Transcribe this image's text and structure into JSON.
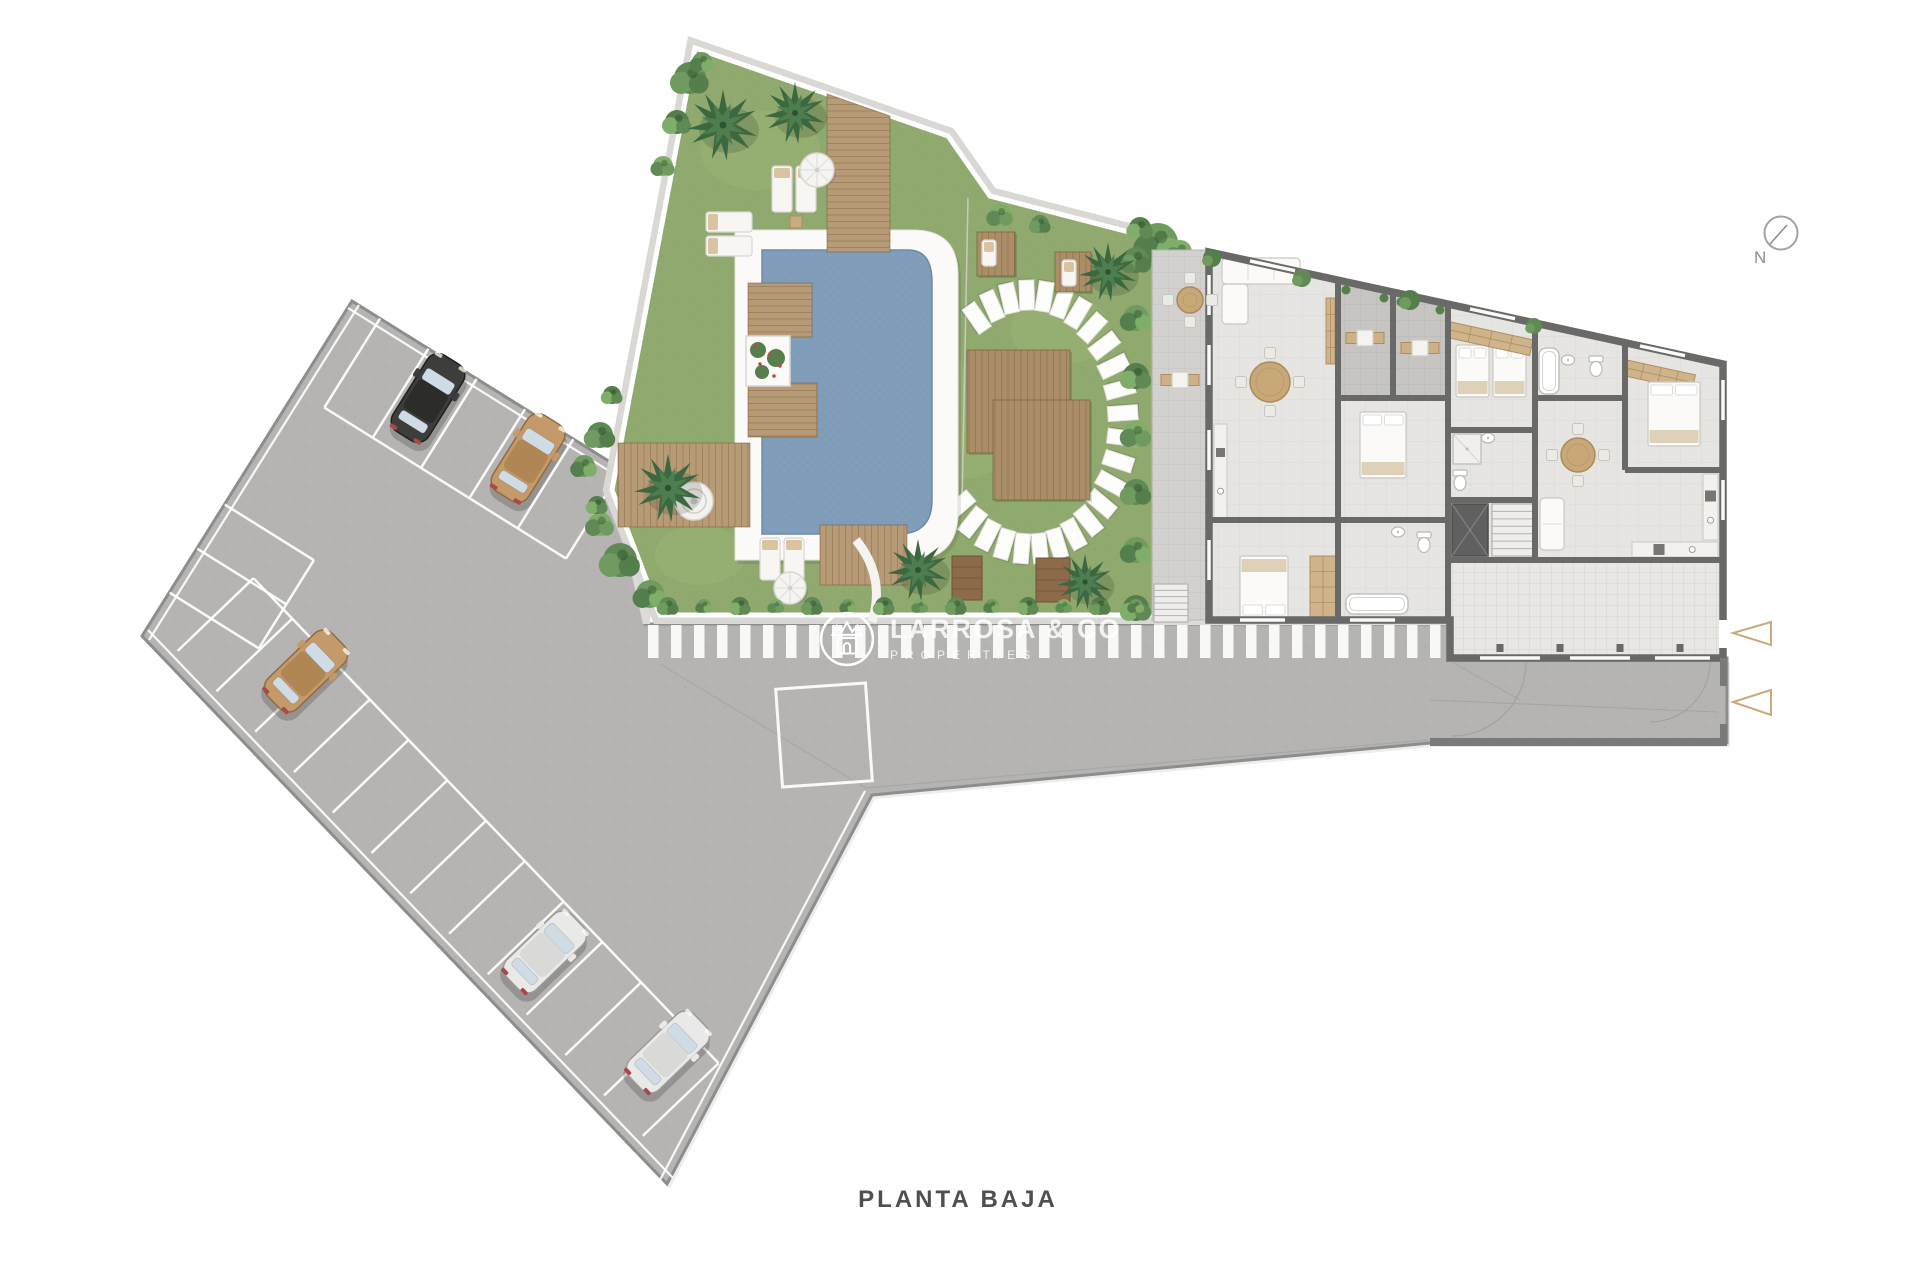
{
  "title": "PLANTA BAJA",
  "compass": {
    "label": "N"
  },
  "watermark": {
    "brand": "LARROSA & CO",
    "tagline": "PROPERTIES"
  },
  "palette": {
    "asphalt": "#b5b4b2",
    "asphalt_edge": "#8d8d8b",
    "sidewalk": "#dcdbd8",
    "grass": "#90a96e",
    "grass_patch": "#a3b87e",
    "pool_water": "#7f9cb8",
    "deck": "#b79b76",
    "wood_dark": "#8d6a49",
    "palm": "#3c6840",
    "palm_light": "#4e7e50",
    "bush": "#5f8a55",
    "wall": "#696967",
    "floor": "#e7e5e1",
    "terrace": "#d2d1ce",
    "patio": "#c6c5c1",
    "wood_furniture": "#cfb38a",
    "arrow": "#c9aa7b",
    "stripe": "#fcfcfa",
    "white_line": "#ffffff"
  },
  "scene": {
    "pavement": {
      "path": "M352,301 L655,490 L645,624 L1452,624 L1452,658 L1727,658 L1727,743 L1430,743 L872,795 L667,1184 L142,636 Z",
      "edge_lines": [
        [
          348,
          308,
          651,
          497
        ],
        [
          359,
          305,
          149,
          640
        ],
        [
          148,
          630,
          673,
          1178
        ],
        [
          660,
          1180,
          865,
          791
        ]
      ],
      "sliver": "M612,488 L657,488 L650,624 L643,624 Z",
      "faint_lines": [
        [
          660,
          664,
          866,
          788
        ],
        [
          866,
          788,
          1428,
          740
        ]
      ],
      "bay": {
        "x": 779,
        "y": 686,
        "w": 90,
        "h": 98,
        "rot": -4
      },
      "stripes": {
        "x0": 648,
        "x1": 1445,
        "y": 625,
        "w": 10.5,
        "h": 33,
        "gap": 23
      },
      "sidewalk2": [
        1154,
        612,
        300,
        13
      ]
    },
    "stall_rows": [
      {
        "x": 352,
        "y": 301,
        "angle": 32,
        "t0": 33,
        "gap": 57,
        "n": 6,
        "depth": 105,
        "side": 1
      },
      {
        "x": 150,
        "y": 622,
        "angle": 46.2,
        "t0": 40,
        "gap": 56,
        "n": 13,
        "depth": 105,
        "side": -1
      },
      {
        "x": 352,
        "y": 301,
        "angle": 122,
        "t0": 240,
        "gap": 52,
        "n": 3,
        "depth": 105,
        "side": -1
      }
    ],
    "cars": [
      {
        "id": "car-black",
        "x": 428,
        "y": 398,
        "rot": 32,
        "body": "#3d3d3b",
        "roof": "#2c2c2a",
        "stroke": "#1f1f1e"
      },
      {
        "id": "car-tan-top",
        "x": 528,
        "y": 458,
        "rot": 32,
        "body": "#c49a6a",
        "roof": "#b08655",
        "stroke": "#8f6b3f"
      },
      {
        "id": "car-tan-left",
        "x": 306,
        "y": 671,
        "rot": 46,
        "body": "#c49a6a",
        "roof": "#b08655",
        "stroke": "#8f6b3f"
      },
      {
        "id": "car-silver-1",
        "x": 545,
        "y": 952,
        "rot": 46,
        "body": "#e9e9e7",
        "roof": "#d9d9d7",
        "stroke": "#9a9a98"
      },
      {
        "id": "car-silver-2",
        "x": 668,
        "y": 1052,
        "rot": 46,
        "body": "#e9e9e7",
        "roof": "#d9d9d7",
        "stroke": "#9a9a98"
      }
    ],
    "garden": {
      "poly": "M695,48 L948,136 L990,196 L1152,238 L1152,615 L660,615 L612,490 Z",
      "hedge_band": [
        1120,
        246,
        34,
        368
      ],
      "patches": [
        [
          760,
          150,
          60,
          40
        ],
        [
          950,
          420,
          85,
          60
        ],
        [
          700,
          555,
          45,
          30
        ],
        [
          1060,
          330,
          50,
          35
        ]
      ],
      "decks": [
        [
          748,
          283,
          64,
          54
        ],
        [
          748,
          383,
          69,
          54
        ],
        [
          618,
          443,
          132,
          84
        ],
        [
          820,
          525,
          87,
          60
        ]
      ],
      "deck_top": "M827,94 L890,116 L890,252 L827,252 Z",
      "pool": {
        "surround": "M735,230 L913,230 Q958,230 958,275 L958,512 Q958,560 910,560 L735,560 Z",
        "water": "M762,250 L908,250 Q932,250 932,282 L932,500 Q932,534 898,534 L762,534 Z"
      },
      "planter": [
        746,
        336,
        44,
        50
      ],
      "spa": [
        694,
        501,
        19
      ],
      "white_curve": "M856,540 Q886,577 872,622",
      "thin_line": [
        968,
        198,
        962,
        505
      ],
      "stones": {
        "cx": 1030,
        "cy": 422,
        "rx": 93,
        "ry": 127,
        "a0": -125,
        "a1": 140,
        "step": 11
      },
      "wood_squares": [
        [
          967,
          350,
          103,
          103
        ],
        [
          993,
          400,
          97,
          100
        ],
        [
          977,
          232,
          38,
          44
        ],
        [
          1055,
          252,
          36,
          40
        ]
      ],
      "benches": [
        [
          952,
          556,
          30,
          44
        ],
        [
          1036,
          558,
          34,
          44
        ]
      ],
      "loungers": [
        [
          772,
          166,
          20,
          46
        ],
        [
          796,
          166,
          20,
          46
        ],
        [
          706,
          212,
          46,
          20
        ],
        [
          706,
          236,
          46,
          20
        ],
        [
          760,
          538,
          20,
          42
        ],
        [
          784,
          538,
          20,
          42
        ],
        [
          982,
          240,
          14,
          26
        ],
        [
          1062,
          260,
          14,
          26
        ]
      ],
      "side_table": [
        790,
        216,
        12,
        12
      ],
      "umbrellas": [
        [
          817,
          170,
          17
        ],
        [
          790,
          588,
          16
        ]
      ],
      "palms": [
        [
          723,
          125,
          1.15
        ],
        [
          795,
          113,
          1.0
        ],
        [
          668,
          488,
          1.1
        ],
        [
          1108,
          272,
          0.95
        ],
        [
          918,
          570,
          1.0
        ],
        [
          1085,
          582,
          0.9
        ]
      ],
      "bushes": [
        [
          690,
          78,
          16
        ],
        [
          702,
          62,
          10
        ],
        [
          677,
          122,
          12
        ],
        [
          663,
          166,
          10
        ],
        [
          600,
          435,
          13
        ],
        [
          584,
          466,
          11
        ],
        [
          612,
          395,
          9
        ],
        [
          600,
          524,
          12
        ],
        [
          620,
          560,
          17
        ],
        [
          650,
          594,
          14
        ],
        [
          597,
          505,
          9
        ],
        [
          1000,
          215,
          11
        ],
        [
          1040,
          224,
          9
        ],
        [
          1158,
          243,
          20
        ],
        [
          1140,
          228,
          11
        ],
        [
          1180,
          252,
          12
        ]
      ],
      "hedge_bushes": {
        "x": 1136,
        "y0": 260,
        "step": 58,
        "n": 7,
        "r": 13
      },
      "bush_row": {
        "x0": 668,
        "x1": 1140,
        "step": 36,
        "y": 606
      }
    },
    "building": {
      "outline": "M1209,252 L1723,364 L1723,658 L1450,658 L1450,620 L1209,620 Z",
      "patios": [
        "M1341,283 L1390,294 L1390,398 L1341,398 Z",
        "M1396,295 L1445,306 L1445,398 L1396,398 Z"
      ],
      "patio_pots": [
        [
          1346,
          290
        ],
        [
          1384,
          298
        ],
        [
          1401,
          302
        ],
        [
          1440,
          310
        ]
      ],
      "garage": [
        1452,
        562,
        269,
        94
      ],
      "walls": [
        [
          1338,
          281,
          1338,
          620
        ],
        [
          1393,
          293,
          1393,
          398
        ],
        [
          1448,
          304,
          1448,
          620
        ],
        [
          1338,
          398,
          1448,
          398
        ],
        [
          1338,
          520,
          1448,
          520
        ],
        [
          1209,
          520,
          1338,
          520
        ],
        [
          1448,
          430,
          1535,
          430
        ],
        [
          1448,
          500,
          1535,
          500
        ],
        [
          1535,
          323,
          1535,
          560
        ],
        [
          1535,
          398,
          1625,
          398
        ],
        [
          1625,
          343,
          1625,
          470
        ],
        [
          1625,
          470,
          1723,
          470
        ],
        [
          1448,
          560,
          1723,
          560
        ]
      ],
      "windows": [
        [
          1240,
          620,
          1285,
          620
        ],
        [
          1350,
          620,
          1395,
          620
        ],
        [
          1480,
          658,
          1540,
          658
        ],
        [
          1570,
          658,
          1630,
          658
        ],
        [
          1655,
          658,
          1710,
          658
        ],
        [
          1209,
          275,
          1209,
          315
        ],
        [
          1209,
          345,
          1209,
          385
        ],
        [
          1209,
          430,
          1209,
          470
        ],
        [
          1209,
          540,
          1209,
          580
        ],
        [
          1250,
          260.9,
          1295,
          270.7
        ],
        [
          1470,
          308.9,
          1515,
          318.7
        ],
        [
          1640,
          345.9,
          1685,
          355.7
        ],
        [
          1723,
          380,
          1723,
          420
        ],
        [
          1723,
          480,
          1723,
          520
        ]
      ],
      "door_gap": [
        1719,
        620,
        9,
        28
      ],
      "furniture": [
        [
          "sofa",
          1222,
          258
        ],
        [
          "wardrobe",
          1326,
          298,
          9,
          66,
          0
        ],
        [
          "tableR",
          1270,
          382,
          20
        ],
        [
          "counter",
          1214,
          424,
          13,
          96
        ],
        [
          "bed",
          1240,
          556,
          48,
          62,
          "bottom"
        ],
        [
          "wardrobe",
          1310,
          556,
          26,
          62,
          0
        ],
        [
          "tableSq",
          1365,
          338
        ],
        [
          "tableSq",
          1420,
          348
        ],
        [
          "bed",
          1360,
          412,
          46,
          66,
          "top"
        ],
        [
          "tub",
          1346,
          594,
          62,
          20
        ],
        [
          "toilet",
          1424,
          542
        ],
        [
          "sink",
          1398,
          532
        ],
        [
          "bed",
          1456,
          345,
          33,
          52,
          "top"
        ],
        [
          "bed",
          1493,
          345,
          33,
          52,
          "top"
        ],
        [
          "tub",
          1539,
          348,
          20,
          46
        ],
        [
          "sink",
          1568,
          360
        ],
        [
          "toilet",
          1596,
          366
        ],
        [
          "wardrobe",
          1451,
          322,
          84,
          16,
          12.3
        ],
        [
          "wardrobe",
          1627,
          360,
          70,
          16,
          12.3
        ],
        [
          "bed",
          1648,
          382,
          52,
          64,
          "top"
        ],
        [
          "tableR",
          1578,
          455,
          17
        ],
        [
          "sofa2",
          1540,
          498,
          24,
          52
        ],
        [
          "counter",
          1632,
          542,
          86,
          15
        ],
        [
          "counter",
          1703,
          474,
          15,
          66
        ],
        [
          "shower",
          1453,
          434,
          28,
          30
        ],
        [
          "toilet",
          1460,
          480
        ],
        [
          "sink",
          1488,
          438
        ]
      ],
      "elevator": [
        1452,
        504,
        36,
        52
      ],
      "stairs": [
        1492,
        504,
        42,
        52
      ],
      "pillars": [
        [
          1500,
          648
        ],
        [
          1560,
          648
        ],
        [
          1620,
          648
        ],
        [
          1680,
          648
        ]
      ],
      "top_bushes": [
        [
          1212,
          258,
          9
        ],
        [
          1302,
          278,
          9
        ],
        [
          1410,
          300,
          10
        ],
        [
          1534,
          326,
          8
        ]
      ],
      "terrace": {
        "rect": [
          1152,
          250,
          57,
          370
        ],
        "tableR": [
          1190,
          300,
          13
        ],
        "tableSq": [
          1180,
          380
        ],
        "stairs": [
          1154,
          584,
          34,
          38
        ]
      },
      "driveway": {
        "bottom_wall": [
          1430,
          738,
          297,
          8
        ],
        "right_walls": [
          [
            1720,
            658,
            7,
            28
          ],
          [
            1720,
            724,
            7,
            16
          ]
        ],
        "arcs": [
          "M1526,662 A74,74 0 0 1 1452,736",
          "M1710,662 A60,60 0 0 1 1650,722"
        ],
        "lines": [
          [
            1430,
            700,
            1718,
            712
          ],
          [
            1452,
            662,
            1520,
            700
          ]
        ]
      }
    },
    "arrows": [
      [
        1771,
        622,
        1733,
        633,
        1771,
        645
      ],
      [
        1771,
        690,
        1733,
        702,
        1771,
        715
      ]
    ]
  }
}
